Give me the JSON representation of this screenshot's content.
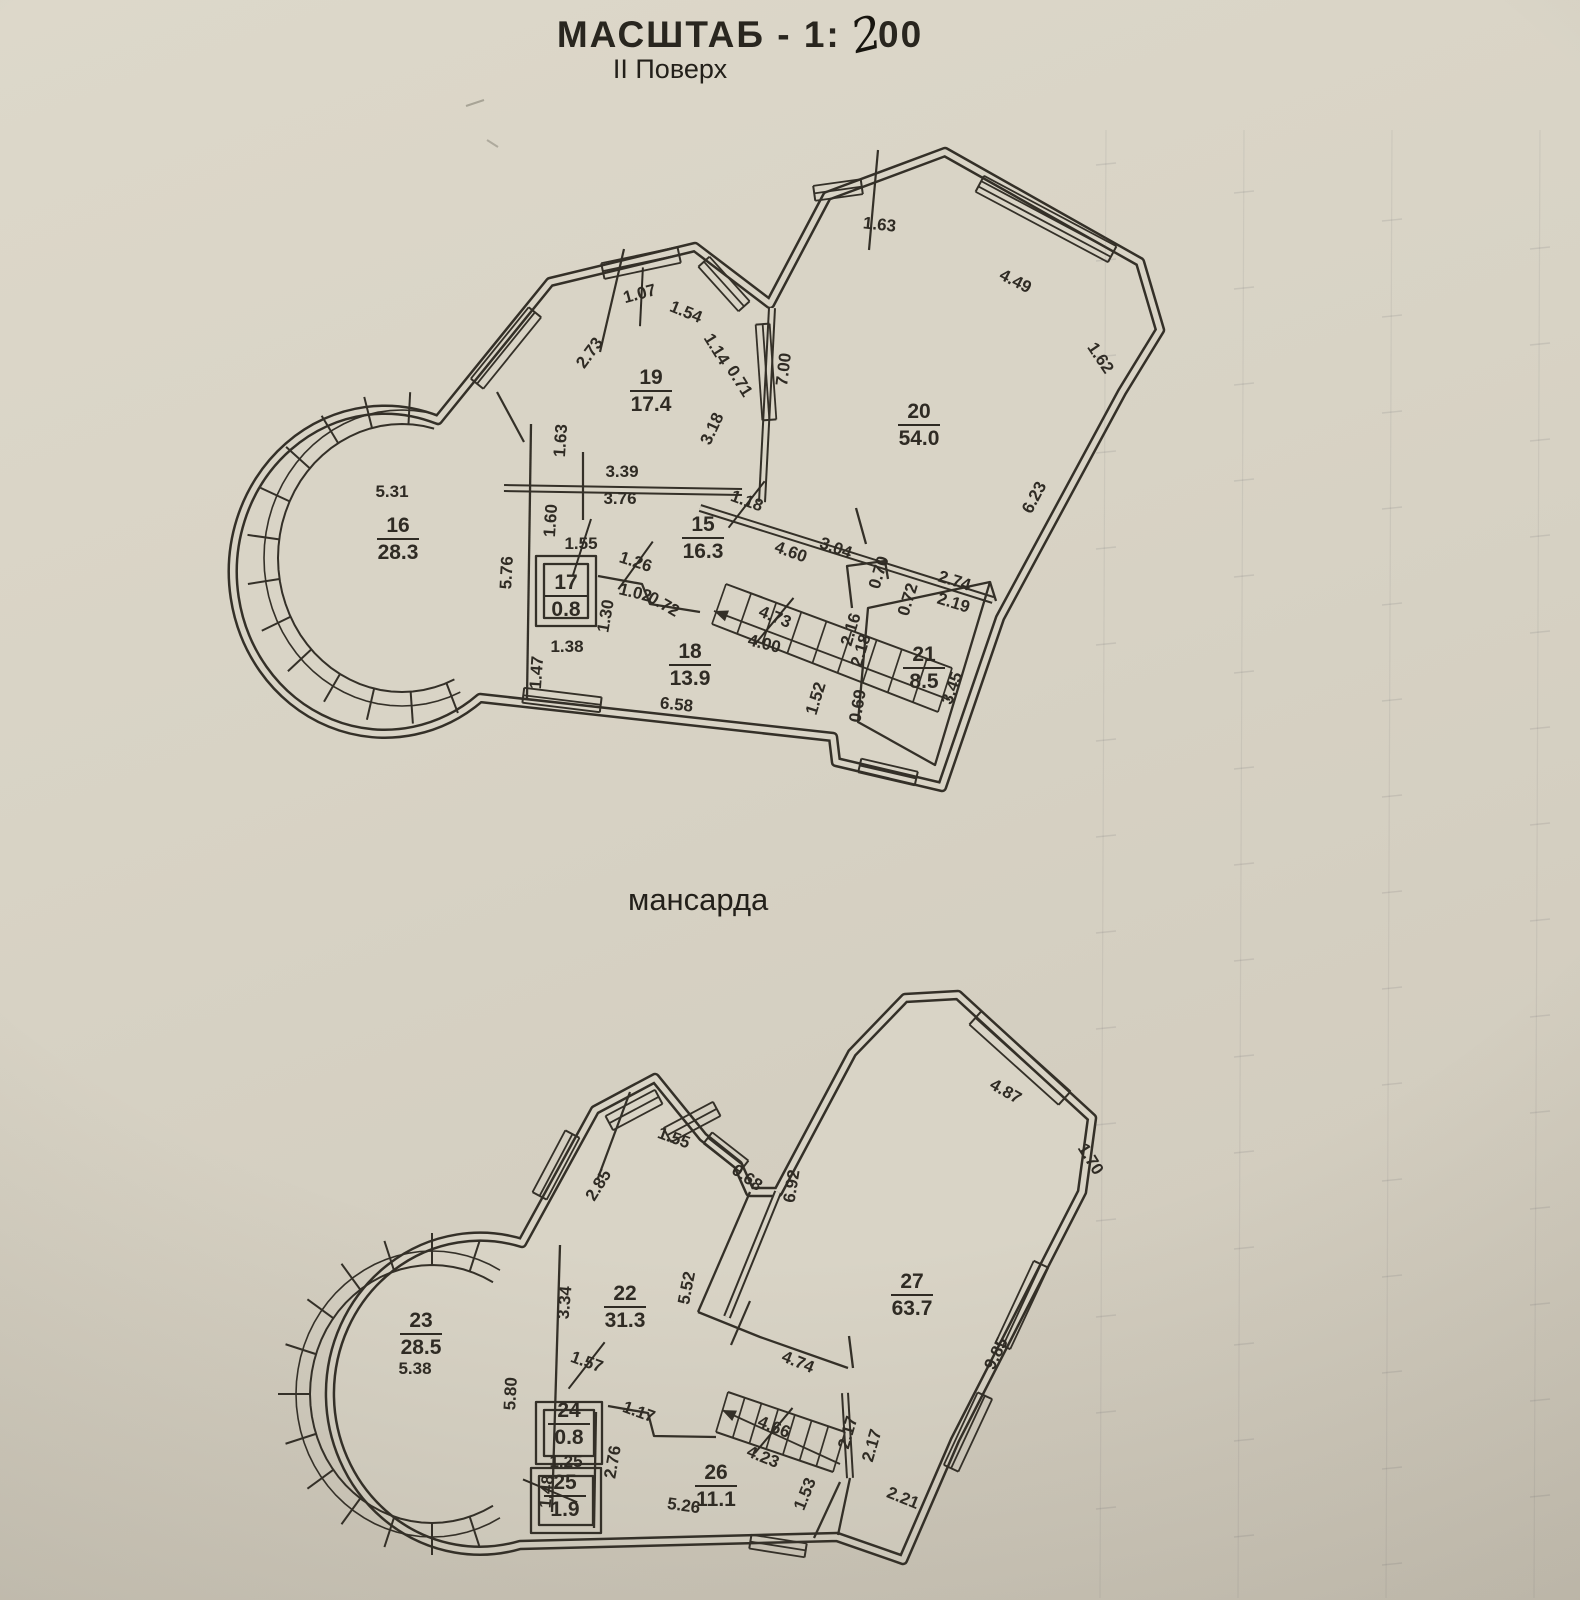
{
  "header": {
    "scale_prefix": "МАСШТАБ - 1:",
    "scale_handwritten": "2",
    "scale_suffix": "00",
    "floor_label": "II Поверх"
  },
  "plans": [
    {
      "id": "floor2",
      "title": "",
      "rooms": [
        {
          "num": "16",
          "area": "28.3",
          "x": 398,
          "y": 532
        },
        {
          "num": "19",
          "area": "17.4",
          "x": 651,
          "y": 384
        },
        {
          "num": "20",
          "area": "54.0",
          "x": 919,
          "y": 418
        },
        {
          "num": "15",
          "area": "16.3",
          "x": 703,
          "y": 531
        },
        {
          "num": "17",
          "area": "0.8",
          "x": 566,
          "y": 589
        },
        {
          "num": "18",
          "area": "13.9",
          "x": 690,
          "y": 658
        },
        {
          "num": "21",
          "area": "8.5",
          "x": 924,
          "y": 661
        }
      ],
      "dims": [
        {
          "t": "5.31",
          "x": 392,
          "y": 497,
          "r": 0
        },
        {
          "t": "1.07",
          "x": 641,
          "y": 299,
          "r": -15,
          "k": 1
        },
        {
          "t": "1.54",
          "x": 684,
          "y": 317,
          "r": 22
        },
        {
          "t": "1.14",
          "x": 712,
          "y": 352,
          "r": 58
        },
        {
          "t": "0.71",
          "x": 735,
          "y": 384,
          "r": 58
        },
        {
          "t": "2.73",
          "x": 594,
          "y": 356,
          "r": -54
        },
        {
          "t": "3.18",
          "x": 717,
          "y": 431,
          "r": -65
        },
        {
          "t": "7.00",
          "x": 789,
          "y": 370,
          "r": -83
        },
        {
          "t": "1.63",
          "x": 879,
          "y": 230,
          "r": 6
        },
        {
          "t": "4.49",
          "x": 1013,
          "y": 286,
          "r": 27
        },
        {
          "t": "1.62",
          "x": 1096,
          "y": 361,
          "r": 56
        },
        {
          "t": "6.23",
          "x": 1039,
          "y": 500,
          "r": -62
        },
        {
          "t": "1.63",
          "x": 566,
          "y": 441,
          "r": -86
        },
        {
          "t": "3.39",
          "x": 622,
          "y": 477,
          "r": 0
        },
        {
          "t": "3.76",
          "x": 620,
          "y": 504,
          "r": 0
        },
        {
          "t": "1.60",
          "x": 556,
          "y": 521,
          "r": -86
        },
        {
          "t": "1.55",
          "x": 581,
          "y": 549,
          "r": 0,
          "k": 1
        },
        {
          "t": "5.76",
          "x": 512,
          "y": 573,
          "r": -87
        },
        {
          "t": "1.18",
          "x": 745,
          "y": 506,
          "r": 20,
          "k": 1
        },
        {
          "t": "4.60",
          "x": 789,
          "y": 557,
          "r": 20
        },
        {
          "t": "3.04",
          "x": 834,
          "y": 553,
          "r": 20
        },
        {
          "t": "0.70",
          "x": 884,
          "y": 574,
          "r": -73
        },
        {
          "t": "2.74",
          "x": 953,
          "y": 586,
          "r": 17
        },
        {
          "t": "0.72",
          "x": 913,
          "y": 601,
          "r": -73
        },
        {
          "t": "2.19",
          "x": 952,
          "y": 608,
          "r": 17
        },
        {
          "t": "1.26",
          "x": 634,
          "y": 567,
          "r": 18,
          "k": 1
        },
        {
          "t": "1.02",
          "x": 634,
          "y": 598,
          "r": 14
        },
        {
          "t": "0.72",
          "x": 661,
          "y": 609,
          "r": 30
        },
        {
          "t": "1.30",
          "x": 611,
          "y": 617,
          "r": -80
        },
        {
          "t": "4.73",
          "x": 773,
          "y": 622,
          "r": 22,
          "k": 1
        },
        {
          "t": "2.16",
          "x": 856,
          "y": 631,
          "r": -73
        },
        {
          "t": "2.18",
          "x": 866,
          "y": 652,
          "r": -73
        },
        {
          "t": "4.00",
          "x": 763,
          "y": 649,
          "r": 14
        },
        {
          "t": "1.38",
          "x": 567,
          "y": 652,
          "r": 0
        },
        {
          "t": "1.47",
          "x": 542,
          "y": 673,
          "r": -86
        },
        {
          "t": "3.45",
          "x": 957,
          "y": 690,
          "r": -70
        },
        {
          "t": "6.58",
          "x": 676,
          "y": 710,
          "r": 6
        },
        {
          "t": "1.52",
          "x": 821,
          "y": 700,
          "r": -73
        },
        {
          "t": "0.69",
          "x": 863,
          "y": 707,
          "r": -80
        }
      ]
    },
    {
      "id": "attic",
      "title": "мансарда",
      "rooms": [
        {
          "num": "23",
          "area": "28.5",
          "x": 421,
          "y": 1327
        },
        {
          "num": "22",
          "area": "31.3",
          "x": 625,
          "y": 1300
        },
        {
          "num": "27",
          "area": "63.7",
          "x": 912,
          "y": 1288
        },
        {
          "num": "24",
          "area": "0.8",
          "x": 569,
          "y": 1417
        },
        {
          "num": "25",
          "area": "1.9",
          "x": 565,
          "y": 1489
        },
        {
          "num": "26",
          "area": "11.1",
          "x": 716,
          "y": 1479
        }
      ],
      "dims": [
        {
          "t": "1.55",
          "x": 672,
          "y": 1143,
          "r": 20
        },
        {
          "t": "0.68",
          "x": 744,
          "y": 1182,
          "r": 35
        },
        {
          "t": "2.85",
          "x": 603,
          "y": 1188,
          "r": -58
        },
        {
          "t": "6.92",
          "x": 797,
          "y": 1187,
          "r": -81
        },
        {
          "t": "4.87",
          "x": 1003,
          "y": 1096,
          "r": 30
        },
        {
          "t": "1.70",
          "x": 1086,
          "y": 1162,
          "r": 58
        },
        {
          "t": "9.85",
          "x": 1001,
          "y": 1356,
          "r": -64
        },
        {
          "t": "5.52",
          "x": 692,
          "y": 1289,
          "r": -79
        },
        {
          "t": "3.34",
          "x": 570,
          "y": 1303,
          "r": -85
        },
        {
          "t": "1.57",
          "x": 585,
          "y": 1367,
          "r": 20,
          "k": 1
        },
        {
          "t": "1.17",
          "x": 637,
          "y": 1417,
          "r": 20
        },
        {
          "t": "4.74",
          "x": 796,
          "y": 1367,
          "r": 22
        },
        {
          "t": "2.17",
          "x": 853,
          "y": 1434,
          "r": -74
        },
        {
          "t": "2.17",
          "x": 877,
          "y": 1447,
          "r": -74
        },
        {
          "t": "4.66",
          "x": 772,
          "y": 1432,
          "r": 22,
          "k": 1
        },
        {
          "t": "4.23",
          "x": 761,
          "y": 1462,
          "r": 22
        },
        {
          "t": "2.76",
          "x": 618,
          "y": 1463,
          "r": -80
        },
        {
          "t": "1.25",
          "x": 566,
          "y": 1467,
          "r": 0
        },
        {
          "t": "1.48",
          "x": 552,
          "y": 1492,
          "r": -85,
          "k": 1
        },
        {
          "t": "5.26",
          "x": 683,
          "y": 1511,
          "r": 8
        },
        {
          "t": "1.53",
          "x": 810,
          "y": 1496,
          "r": -68
        },
        {
          "t": "2.21",
          "x": 901,
          "y": 1503,
          "r": 22
        },
        {
          "t": "5.80",
          "x": 516,
          "y": 1394,
          "r": -87
        },
        {
          "t": "5.38",
          "x": 415,
          "y": 1374,
          "r": 0
        }
      ]
    }
  ]
}
